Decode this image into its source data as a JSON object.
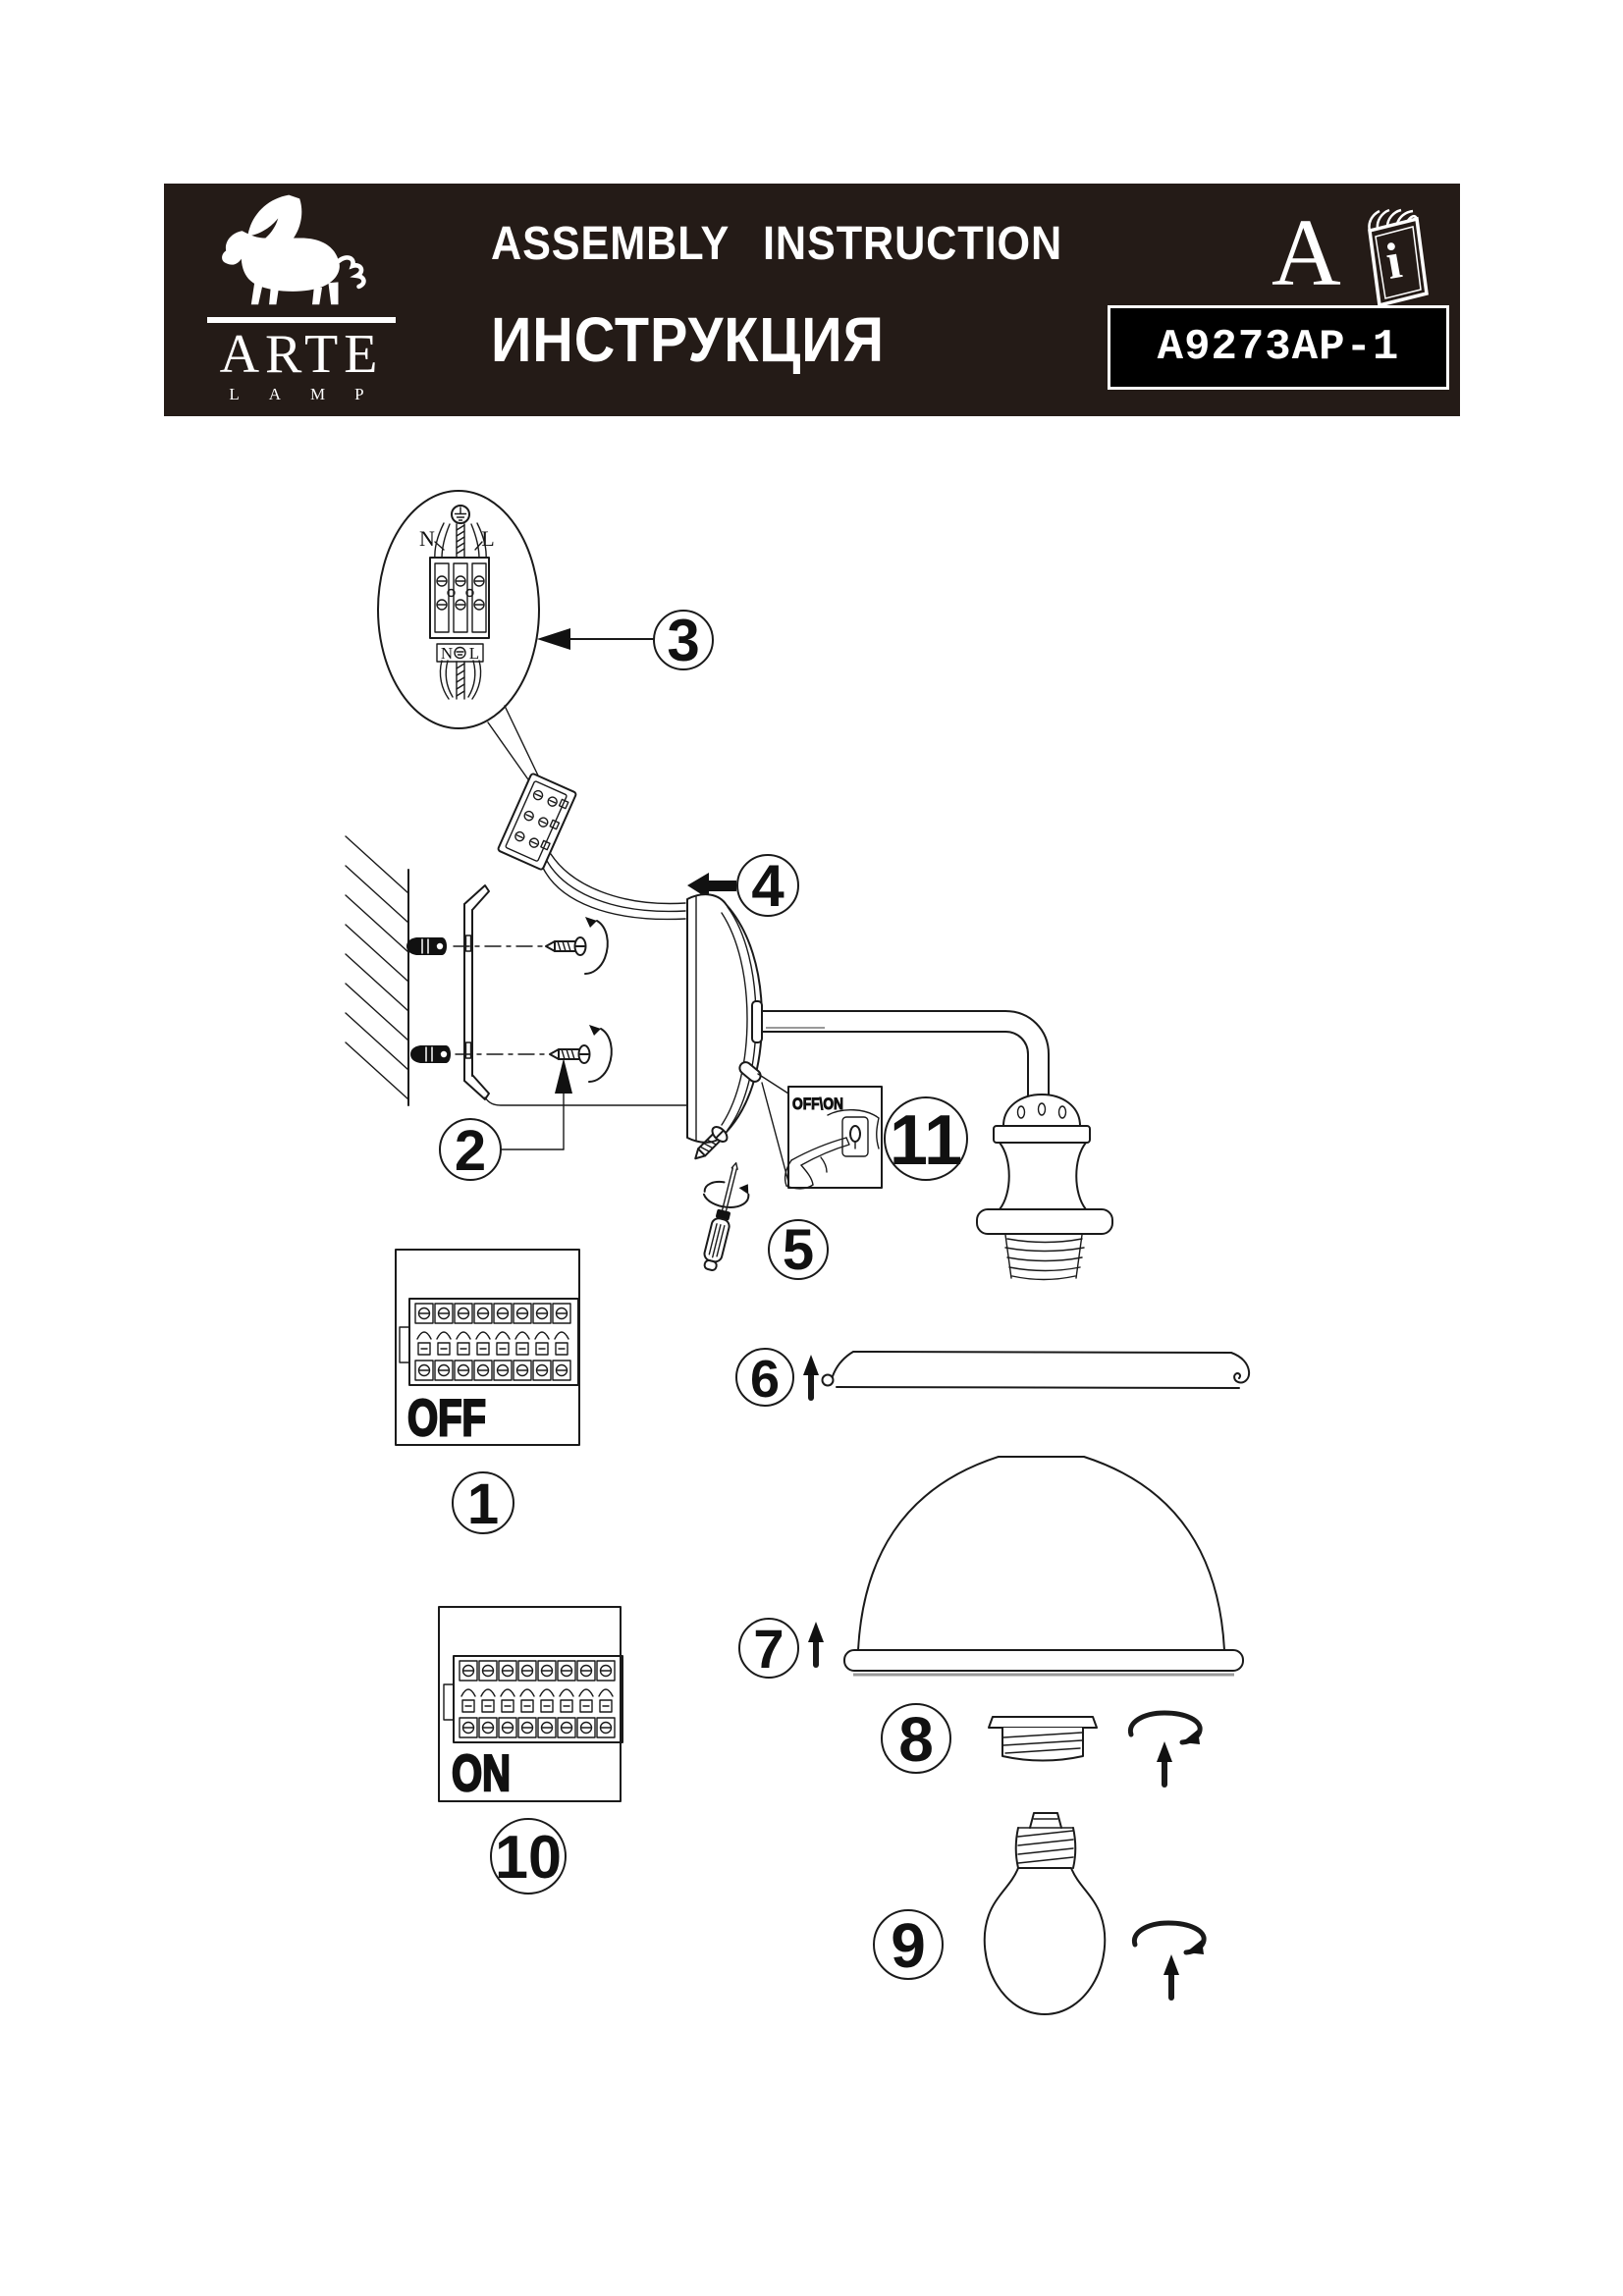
{
  "colors": {
    "band_bg": "#241b17",
    "ink": "#1a1a1a",
    "paper": "#ffffff",
    "model_box_bg": "#000000",
    "model_box_text": "#ffffff",
    "shade_shadow": "#999999"
  },
  "header": {
    "logo_icon": "winged-lion-icon",
    "brand_name": "ARTE",
    "brand_sub": "LAMP",
    "title_en": "ASSEMBLY INSTRUCTION",
    "title_ru": "ИНСТРУКЦИЯ",
    "section_letter": "A",
    "manual_icon": "open-booklet-icon",
    "manual_icon_letter": "i",
    "model_code": "A9273AP-1"
  },
  "diagram": {
    "callouts": {
      "c1": "1",
      "c2": "2",
      "c3": "3",
      "c4": "4",
      "c5": "5",
      "c6": "6",
      "c7": "7",
      "c8": "8",
      "c9": "9",
      "c10": "10",
      "c11": "11"
    },
    "wiring": {
      "neutral": "N",
      "live": "L",
      "strip_neutral": "N",
      "strip_live": "L"
    },
    "switch_detail_label": "OFF\\ON",
    "off_label": "OFF",
    "on_label": "ON",
    "icons": {
      "earth": "earth-ground-icon",
      "rotate": "rotate-clockwise-icon",
      "up": "arrow-up-icon",
      "left": "arrow-left-icon"
    }
  }
}
